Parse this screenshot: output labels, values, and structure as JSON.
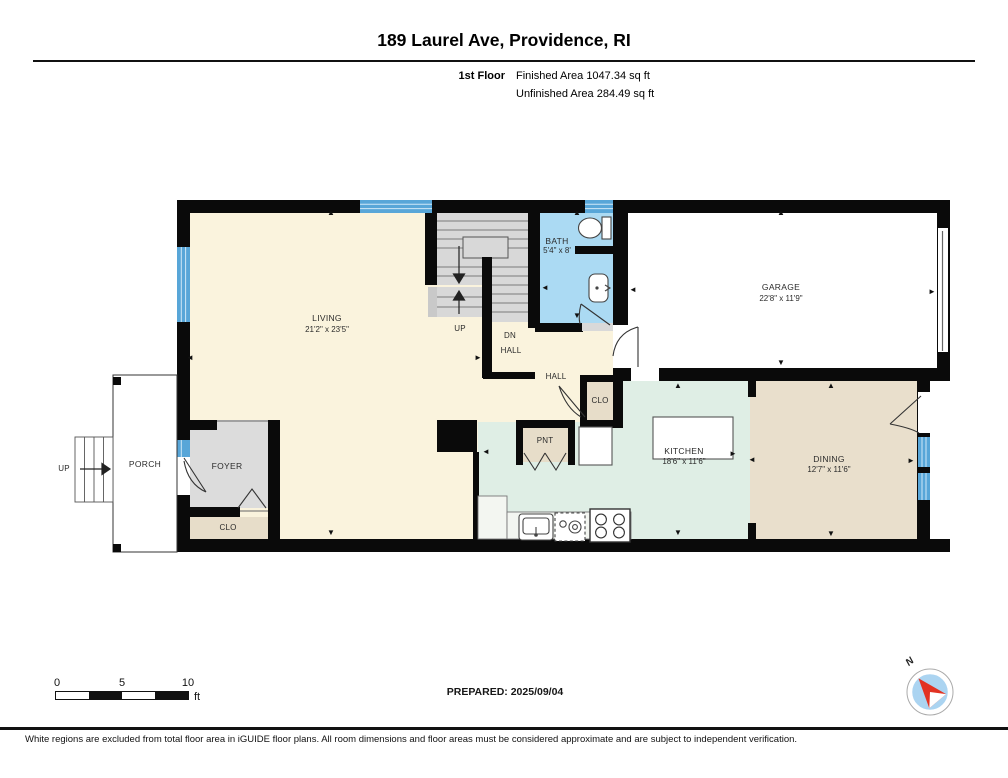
{
  "header": {
    "title": "189 Laurel Ave, Providence, RI",
    "floor_label": "1st Floor",
    "finished_area": "Finished Area 1047.34 sq ft",
    "unfinished_area": "Unfinished Area 284.49 sq ft"
  },
  "rooms": {
    "living": {
      "name": "LIVING",
      "dims": "21'2\" x 23'5\""
    },
    "bath": {
      "name": "BATH",
      "dims": "5'4\" x 8'"
    },
    "garage": {
      "name": "GARAGE",
      "dims": "22'8\" x 11'9\""
    },
    "kitchen": {
      "name": "KITCHEN",
      "dims": "18'6\" x 11'6\""
    },
    "dining": {
      "name": "DINING",
      "dims": "12'7\" x 11'6\""
    },
    "porch": {
      "name": "PORCH"
    },
    "foyer": {
      "name": "FOYER"
    },
    "foyer_closet": {
      "name": "CLO"
    },
    "hall_closet": {
      "name": "CLO"
    },
    "pantry": {
      "name": "PNT"
    },
    "hall": {
      "name": "HALL"
    },
    "stair_hall": {
      "dn": "DN",
      "hall": "HALL",
      "up": "UP"
    },
    "exterior_stairs": {
      "up": "UP"
    }
  },
  "glyphs": {
    "up": "▲",
    "down": "▼",
    "left": "◄",
    "right": "►"
  },
  "footer": {
    "scale": {
      "t0": "0",
      "t5": "5",
      "t10": "10",
      "unit": "ft"
    },
    "prepared": "PREPARED: 2025/09/04",
    "compass_n": "N",
    "disclaimer": "White regions are excluded from total floor area in iGUIDE floor plans. All room dimensions and floor areas must be considered approximate and are subject to independent verification."
  },
  "colors": {
    "wall": "#0a0a0a",
    "living_cream": "#faf3dd",
    "bath_blue": "#abdaf3",
    "window_blue": "#58a6d8",
    "kitchen_green": "#dfeee5",
    "dining_tan": "#e9dfcc",
    "closet_tan": "#e7ddc9",
    "foyer_gray": "#dcdcdc",
    "stairs_gray": "#d8d8d8",
    "garage_white": "#ffffff",
    "compass_blue": "#abd4f1",
    "needle_red": "#e23222"
  }
}
